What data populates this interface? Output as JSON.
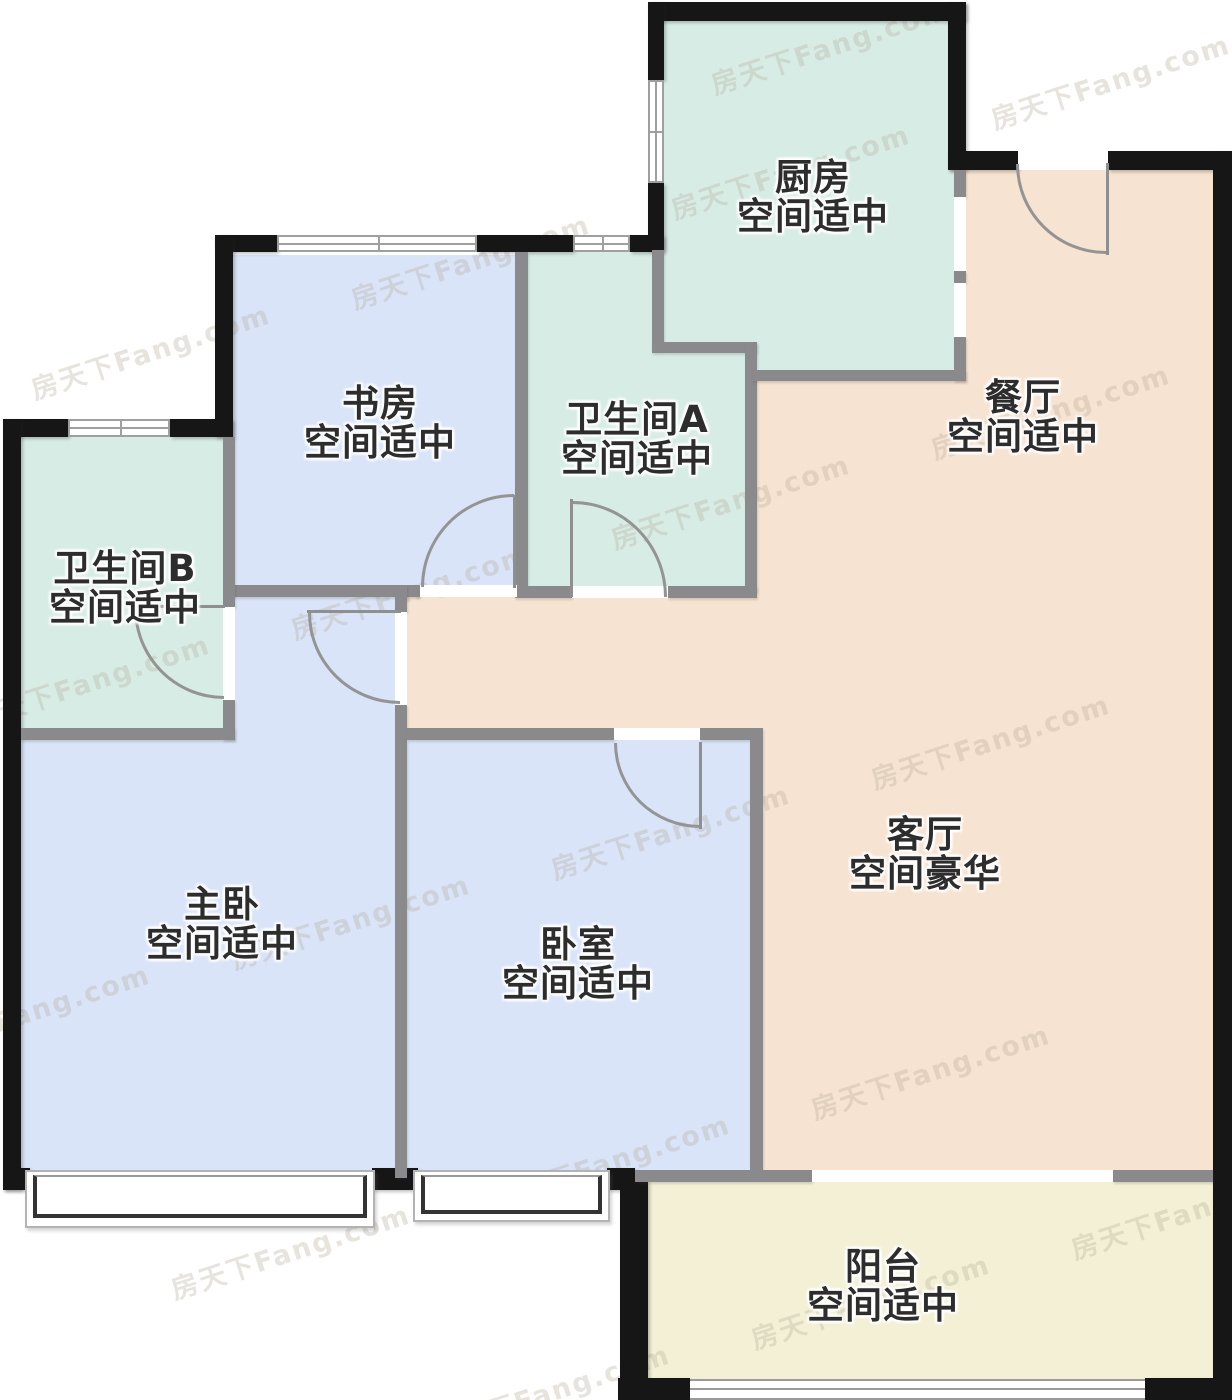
{
  "floorplan": {
    "watermark_text": "房天下Fang.com",
    "rooms": [
      {
        "id": "kitchen",
        "name": "厨房",
        "size_label": "空间适中"
      },
      {
        "id": "dining",
        "name": "餐厅",
        "size_label": "空间适中"
      },
      {
        "id": "study",
        "name": "书房",
        "size_label": "空间适中"
      },
      {
        "id": "bath_a",
        "name": "卫生间A",
        "size_label": "空间适中"
      },
      {
        "id": "bath_b",
        "name": "卫生间B",
        "size_label": "空间适中"
      },
      {
        "id": "master",
        "name": "主卧",
        "size_label": "空间适中"
      },
      {
        "id": "bedroom",
        "name": "卧室",
        "size_label": "空间适中"
      },
      {
        "id": "living",
        "name": "客厅",
        "size_label": "空间豪华"
      },
      {
        "id": "balcony",
        "name": "阳台",
        "size_label": "空间适中"
      }
    ],
    "colors": {
      "wet_room_floor": "#d8ece6",
      "bedroom_floor": "#d9e4f8",
      "living_floor": "#f6e3d1",
      "balcony_floor": "#f3f0d6",
      "exterior_wall": "#161616",
      "interior_wall": "#8a8a8d",
      "door_line": "#8f8f8f"
    }
  }
}
